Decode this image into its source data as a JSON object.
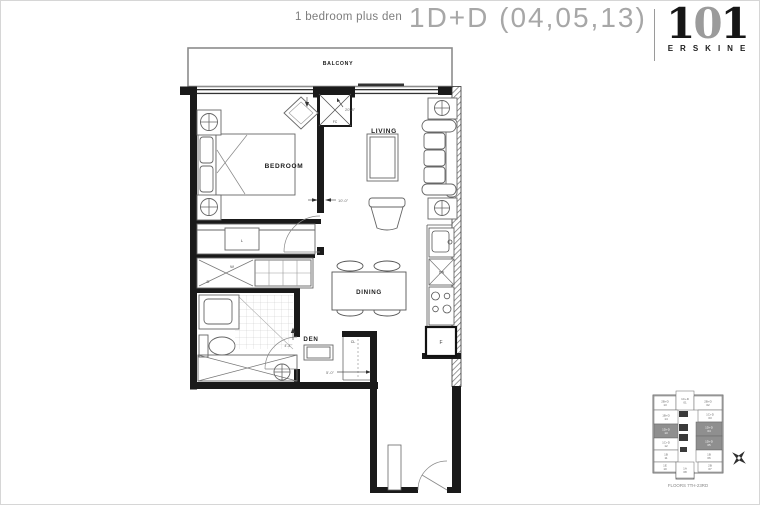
{
  "header": {
    "type_label": "1 bedroom plus den",
    "title": "1D+D (04,05,13)",
    "logo_number_parts": {
      "left": "1",
      "middle": "0",
      "right": "1"
    },
    "logo_name": "ERSKINE"
  },
  "plan": {
    "room_labels": {
      "balcony": "BALCONY",
      "bedroom": "BEDROOM",
      "living": "LIVING",
      "dining": "DINING",
      "den": "DEN"
    },
    "fixture_labels": {
      "closet": "CL",
      "washer": "W",
      "dryer": "D",
      "linen": "L",
      "fridge": "F",
      "dishwasher": "DW",
      "fan_coil": "FC"
    },
    "dimensions": {
      "living": "20'-8\"",
      "bedroom": "10'-0\"",
      "den_width": "5'-0\"",
      "den_depth": "4'-3\""
    }
  },
  "keyplan": {
    "caption": "FLOORS 7TH-23RD",
    "highlight_color": "#8f8f8f",
    "units": [
      {
        "label": "2B+D",
        "num": "13",
        "x": 8,
        "y": 10,
        "w": 22,
        "h": 14,
        "hl": false
      },
      {
        "label": "1C+D",
        "num": "01",
        "x": 30,
        "y": 5,
        "w": 18,
        "h": 19,
        "hl": false
      },
      {
        "label": "2B+D",
        "num": "02",
        "x": 48,
        "y": 10,
        "w": 28,
        "h": 14,
        "hl": false
      },
      {
        "label": "1B+D",
        "num": "14",
        "x": 8,
        "y": 24,
        "w": 24,
        "h": 14,
        "hl": false
      },
      {
        "label": "1C+D",
        "num": "03",
        "x": 52,
        "y": 24,
        "w": 24,
        "h": 12,
        "hl": false
      },
      {
        "label": "1D+D",
        "num": "13",
        "x": 8,
        "y": 38,
        "w": 24,
        "h": 14,
        "hl": true
      },
      {
        "label": "1D+D",
        "num": "04",
        "x": 50,
        "y": 36,
        "w": 26,
        "h": 14,
        "hl": true
      },
      {
        "label": "1C+D",
        "num": "12",
        "x": 8,
        "y": 52,
        "w": 24,
        "h": 12,
        "hl": false
      },
      {
        "label": "1D+D",
        "num": "05",
        "x": 50,
        "y": 50,
        "w": 26,
        "h": 14,
        "hl": true
      },
      {
        "label": "1B",
        "num": "11",
        "x": 8,
        "y": 64,
        "w": 24,
        "h": 12,
        "hl": false
      },
      {
        "label": "1B",
        "num": "06",
        "x": 50,
        "y": 64,
        "w": 26,
        "h": 12,
        "hl": false
      },
      {
        "label": "1E",
        "num": "10",
        "x": 8,
        "y": 76,
        "w": 22,
        "h": 10,
        "hl": false
      },
      {
        "label": "1A",
        "num": "08",
        "x": 30,
        "y": 76,
        "w": 18,
        "h": 16,
        "hl": false
      },
      {
        "label": "2B",
        "num": "07",
        "x": 52,
        "y": 76,
        "w": 24,
        "h": 10,
        "hl": false
      }
    ]
  }
}
